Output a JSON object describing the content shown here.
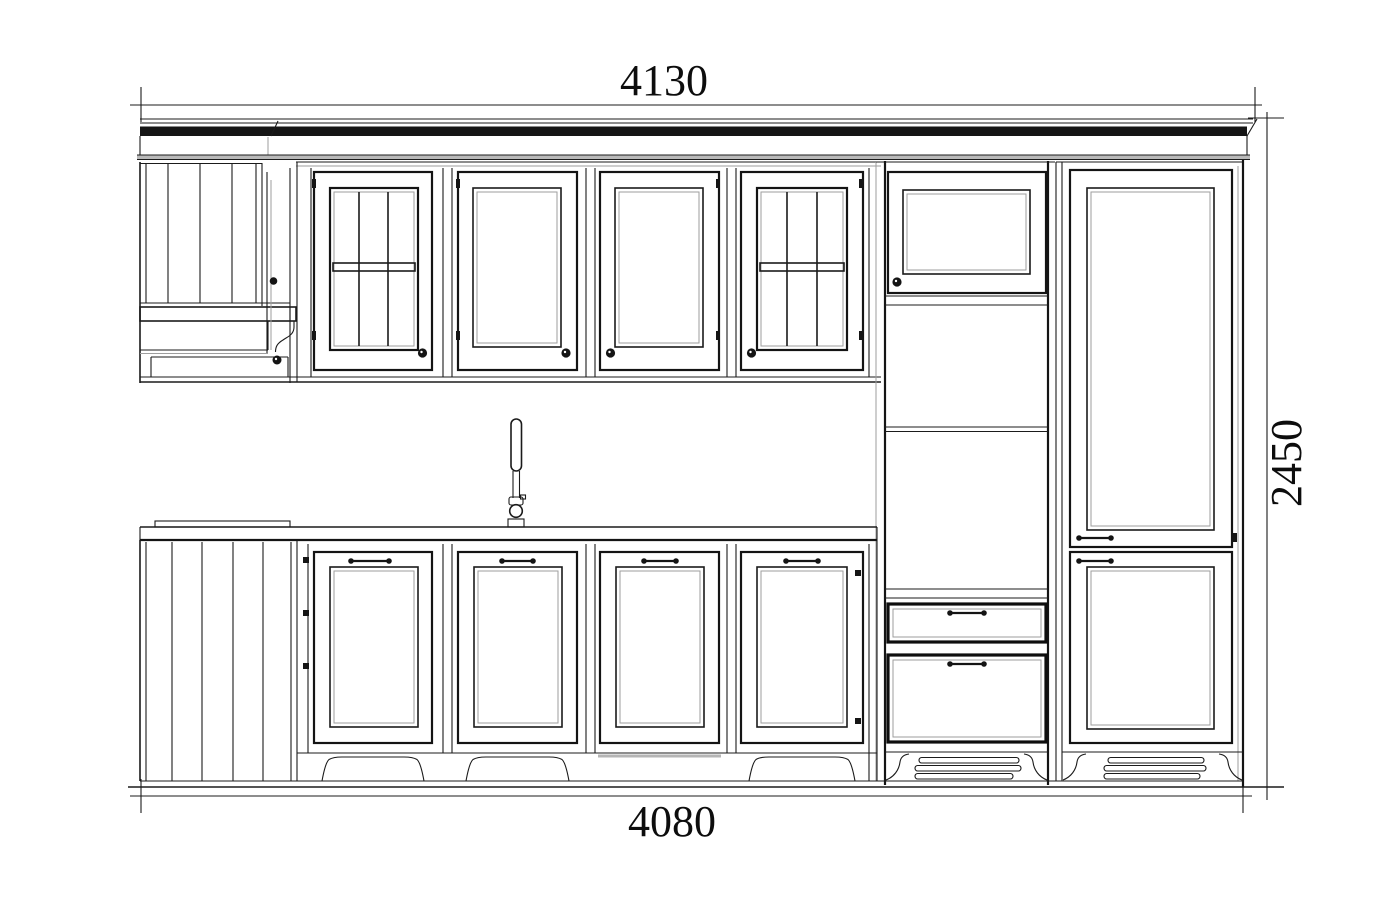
{
  "page": {
    "background": "#ffffff"
  },
  "dimensions": {
    "top_width": "4130",
    "bottom_width": "4080",
    "height": "2450"
  },
  "line_colors": {
    "primary": "#1b1b1b",
    "secondary": "#9e9e9e"
  },
  "components": {
    "hood": "range-hood-with-shelf-and-corbel",
    "upper_doors": [
      "glass-mullion-door",
      "panel-door",
      "panel-door",
      "glass-mullion-door"
    ],
    "tall_units": [
      "appliance-column-with-drawers",
      "fridge-column-two-doors"
    ],
    "base_doors": [
      "panel-door",
      "panel-door",
      "panel-door",
      "panel-door"
    ],
    "fixtures": [
      "kitchen-faucet",
      "countertop"
    ],
    "vents": [
      "plinth-vent-grille",
      "plinth-vent-grille"
    ]
  }
}
